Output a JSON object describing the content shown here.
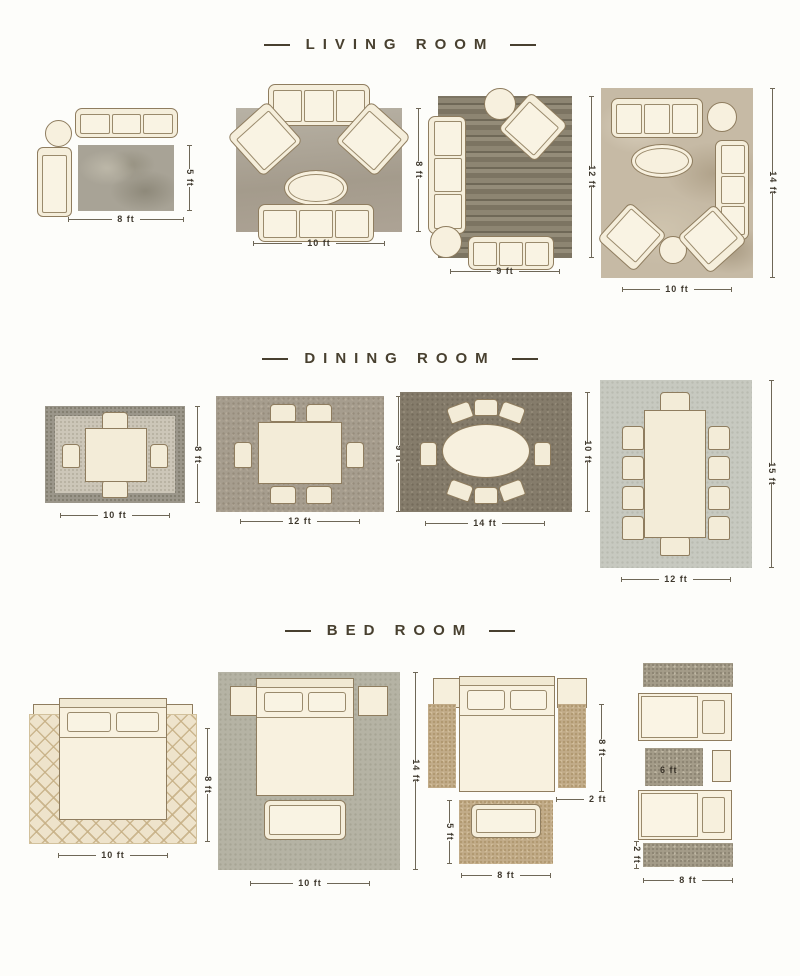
{
  "colors": {
    "page_background": "#fdfdfa",
    "title_text": "#48402f",
    "dimension_text": "#3e382d",
    "furniture_fill": "#f7f0de",
    "furniture_outline": "#8f7d5f"
  },
  "titles": {
    "living": "LIVING ROOM",
    "dining": "DINING ROOM",
    "bed": "BED ROOM"
  },
  "living": {
    "l1": {
      "width": "8 ft",
      "height": "5 ft"
    },
    "l2": {
      "width": "10 ft",
      "height": "8 ft"
    },
    "l3": {
      "width": "9 ft",
      "height": "12 ft"
    },
    "l4": {
      "width": "10 ft",
      "height": "14 ft"
    }
  },
  "dining": {
    "d1": {
      "width": "10 ft",
      "height": "8 ft"
    },
    "d2": {
      "width": "12 ft",
      "height": "9 ft"
    },
    "d3": {
      "width": "14 ft",
      "height": "10 ft"
    },
    "d4": {
      "width": "12 ft",
      "height": "15 ft"
    }
  },
  "bed": {
    "b1": {
      "width": "10 ft",
      "height": "8 ft"
    },
    "b2": {
      "width": "10 ft",
      "height": "14 ft"
    },
    "b3": {
      "runner_height": "8 ft",
      "runner_width": "2 ft",
      "foot_rug_width": "8 ft",
      "foot_rug_height": "5 ft"
    },
    "b4": {
      "between_rug_length": "6 ft",
      "runner_width": "2 ft",
      "width": "8 ft"
    }
  }
}
